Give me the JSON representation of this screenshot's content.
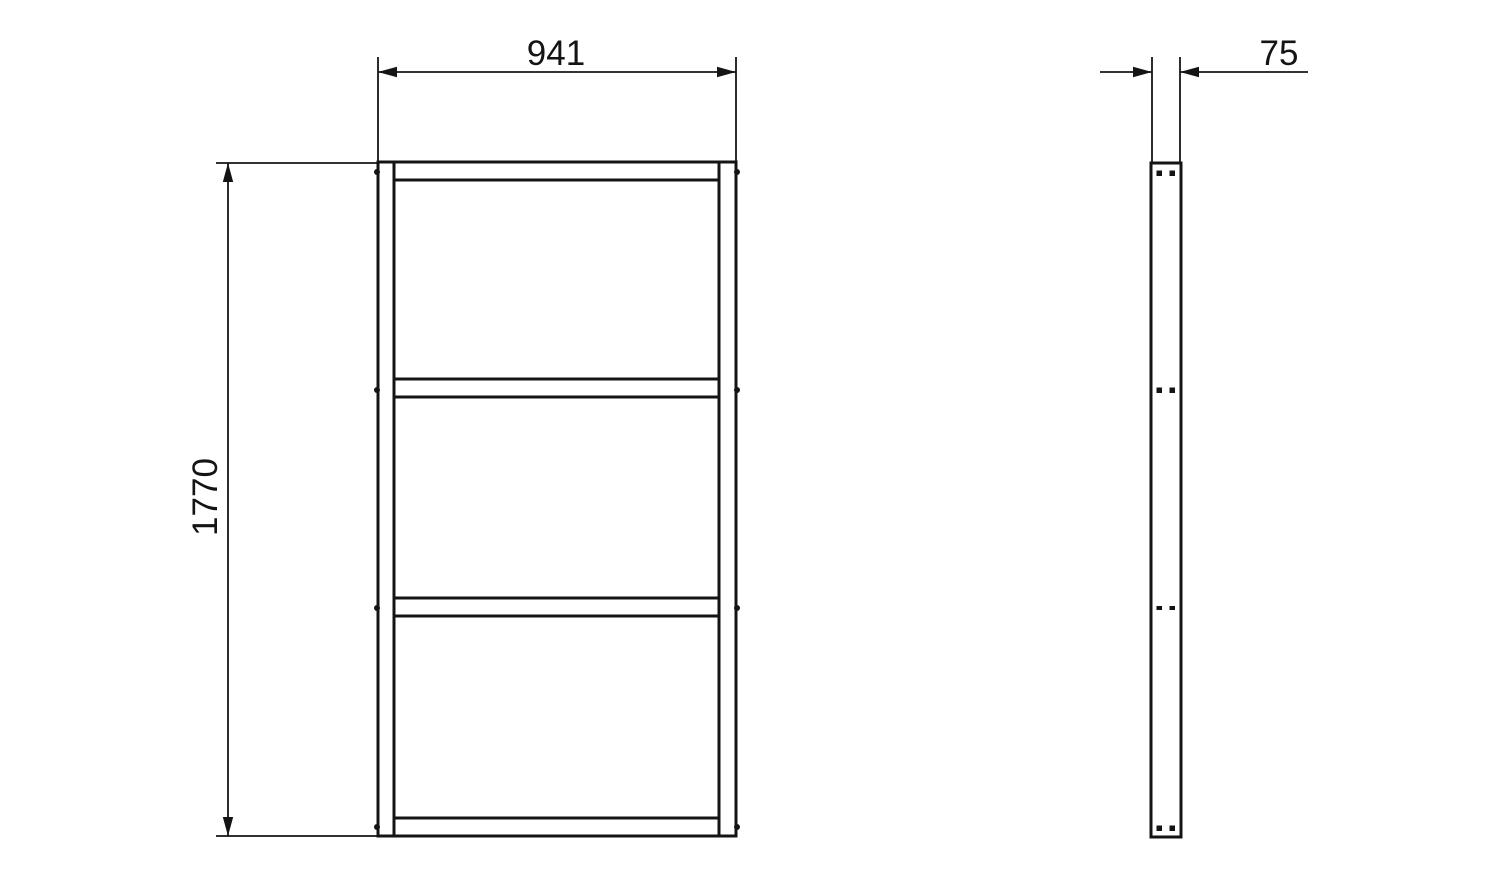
{
  "drawing": {
    "type": "technical-drawing",
    "background_color": "#ffffff",
    "line_color": "#141414",
    "front_view": {
      "name": "front-elevation",
      "width_dim_label": "941",
      "height_dim_label": "1770",
      "shelf_sections": 3,
      "fastener_rows": 4
    },
    "side_view": {
      "name": "side-profile",
      "depth_dim_label": "75",
      "fastener_rows": 4,
      "fasteners_per_row": 2
    }
  }
}
